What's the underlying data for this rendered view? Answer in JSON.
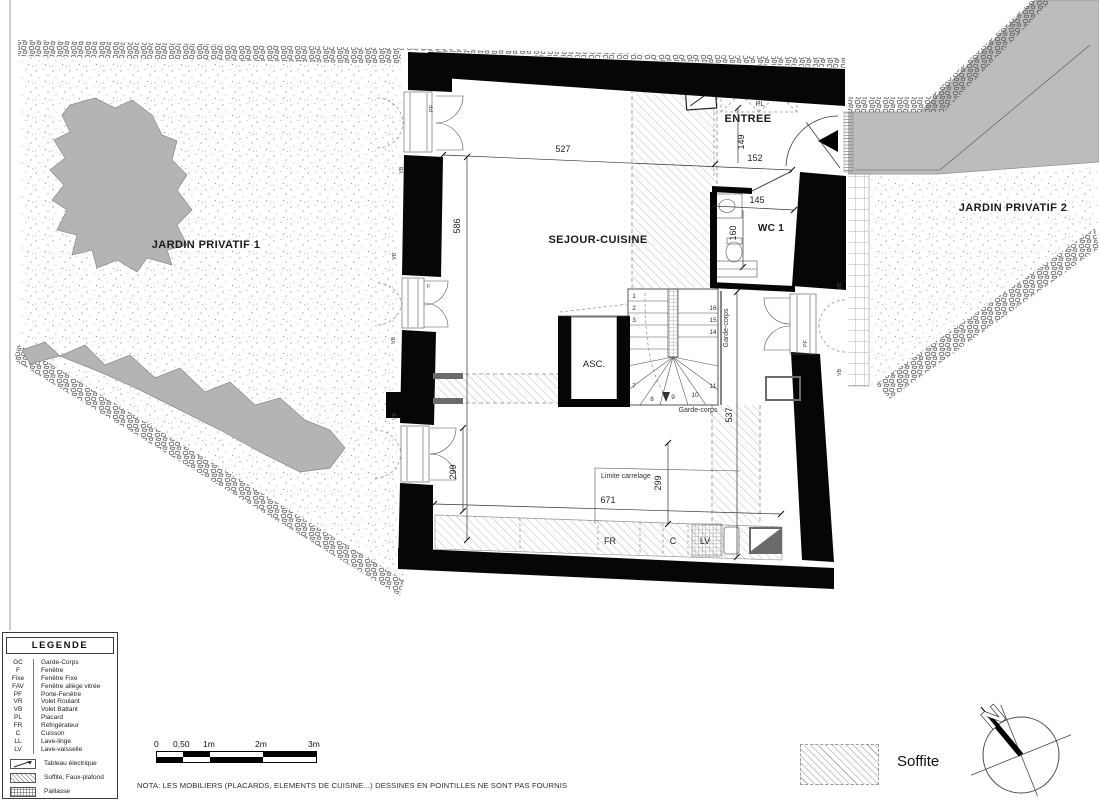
{
  "plan": {
    "labels": {
      "garden1": "JARDIN PRIVATIF 1",
      "garden2": "JARDIN PRIVATIF 2",
      "sejour": "SEJOUR-CUISINE",
      "entree": "ENTREE",
      "wc": "WC 1",
      "asc": "ASC.",
      "pl": "PL",
      "fr": "FR",
      "cuisson": "C",
      "lv": "LV"
    },
    "dimensions": {
      "top_width": "527",
      "left_height": "586",
      "entree_depth": "149",
      "entree_width": "152",
      "wc_width": "145",
      "wc_depth": "160",
      "right_height": "537",
      "door_left": "299",
      "carrelage": "299",
      "kitchen_width": "671"
    },
    "annotations": {
      "limite_carrelage": "Limite carrelage",
      "garde_corps": "Garde-corps",
      "pf": "PF",
      "vb": "VB",
      "f": "F"
    },
    "stair_numbers": [
      "1",
      "2",
      "3",
      "7",
      "8",
      "9",
      "10",
      "11",
      "14",
      "15",
      "16"
    ]
  },
  "legend": {
    "title": "LEGENDE",
    "items": [
      {
        "abbr": "GC",
        "label": "Garde-Corps"
      },
      {
        "abbr": "F",
        "label": "Fenêtre"
      },
      {
        "abbr": "Fixe",
        "label": "Fenêtre Fixe"
      },
      {
        "abbr": "FAV",
        "label": "Fenêtre allège vitrée"
      },
      {
        "abbr": "PF",
        "label": "Porte-Fenêtre"
      },
      {
        "abbr": "VR",
        "label": "Volet Roulant"
      },
      {
        "abbr": "VB",
        "label": "Volet Battant"
      },
      {
        "abbr": "PL",
        "label": "Placard"
      },
      {
        "abbr": "FR",
        "label": "Réfrigérateur"
      },
      {
        "abbr": "C",
        "label": "Cuisson"
      },
      {
        "abbr": "LL",
        "label": "Lave-linge"
      },
      {
        "abbr": "LV",
        "label": "Lave-vaisselle"
      }
    ],
    "symbols": [
      {
        "icon": "tableau-electrique-icon",
        "label": "Tableau électrique"
      },
      {
        "icon": "soffite-hatch-icon",
        "label": "Soffite, Faux-plafond"
      },
      {
        "icon": "paillasse-grid-icon",
        "label": "Paillasse"
      }
    ]
  },
  "scalebar": {
    "labels": [
      "0",
      "0,50",
      "1m",
      "2m",
      "3m"
    ]
  },
  "nota": "NOTA: LES MOBILIERS (PLACARDS, ELEMENTS DE CUISINE...) DESSINES EN POINTILLES NE SONT PAS FOURNIS",
  "soffite_key": {
    "label": "Soffite"
  },
  "compass": {
    "label": "N"
  },
  "colors": {
    "wall": "#000000",
    "ramp": "#bcbcbc",
    "tree": "#b4b4b4",
    "hatch_line": "#b5b5b5"
  }
}
